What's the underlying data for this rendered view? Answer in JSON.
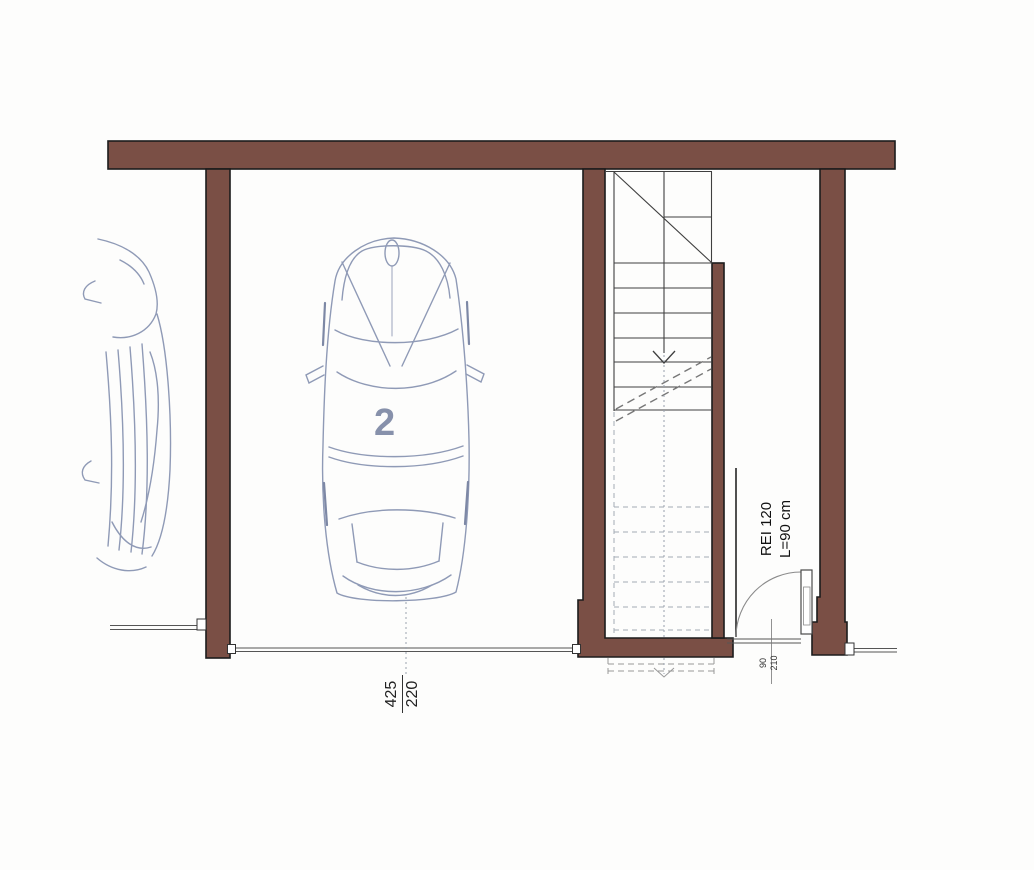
{
  "plan": {
    "parking_space_label": "2",
    "garage_opening": {
      "width_label": "425",
      "height_label": "220"
    },
    "fire_door": {
      "rating": "REI 120",
      "width_note": "L=90 cm",
      "dim_width": "90",
      "dim_height": "210"
    },
    "colors": {
      "wall": "#7a4f45",
      "wall_outline": "#1c1c1c",
      "car_sketch": "#8f9ab6",
      "space_label_blue": "#8791ab",
      "stair_line": "#3f3f3f",
      "light_dashed": "#a2aab4"
    }
  }
}
